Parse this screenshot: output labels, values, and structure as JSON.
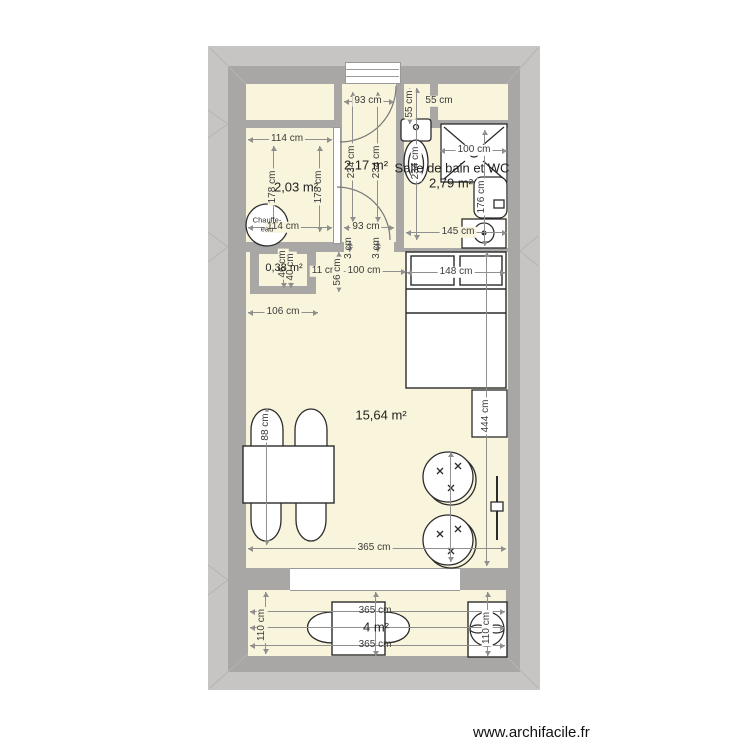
{
  "plan": {
    "tool_watermark": "www.archifacile.fr",
    "rooms": {
      "storage": {
        "area": "2,03 m²"
      },
      "hallway": {
        "area": "2,17 m²"
      },
      "bathroom": {
        "name": "Salle de bain et WC",
        "area": "2,79 m²"
      },
      "closet": {
        "area": "0,38 m²"
      },
      "living": {
        "area": "15,64 m²"
      },
      "balcony": {
        "area": "4 m²"
      }
    },
    "furniture_labels": {
      "water_heater_line1": "Chauffe-",
      "water_heater_line2": "eau"
    },
    "dims": {
      "hall_top_width": "93 cm",
      "strip_height_v": "55 cm",
      "strip_width_h": "55 cm",
      "storage_top_width": "114 cm",
      "storage_height_left": "178 cm",
      "storage_height_right": "178 cm",
      "hall_height_left": "234 cm",
      "hall_height_right": "234 cm",
      "bath_height_toilet": "234 cm",
      "shower_width": "100 cm",
      "bath_height_right": "176 cm",
      "bath_bottom_width": "145 cm",
      "storage_bottom_width": "114 cm",
      "hall_bottom_width": "93 cm",
      "closet_depth_a": "46 cm",
      "closet_depth_b": "40 cm",
      "closet_gap": "11 cm",
      "gap_left": "3 cm",
      "gap_right": "3 cm",
      "closet_side": "56 cm",
      "bed_gap_width": "100 cm",
      "bed_width": "148 cm",
      "closet_bottom_width": "106 cm",
      "living_height": "444 cm",
      "chair_width": "88 cm",
      "living_width": "365 cm",
      "balcony_depth": "110 cm",
      "balcony_table_top": "365 cm",
      "balcony_table_bottom": "365 cm",
      "balcony_fan_depth": "110 cm"
    },
    "colors": {
      "room_fill": "#f9f5dc",
      "wall": "#a8a7a5",
      "wall_outer_band": "#c6c5c3",
      "dimension_line": "#8f8f8f",
      "furniture_stroke": "#2b2b2b",
      "background": "#ffffff"
    }
  }
}
